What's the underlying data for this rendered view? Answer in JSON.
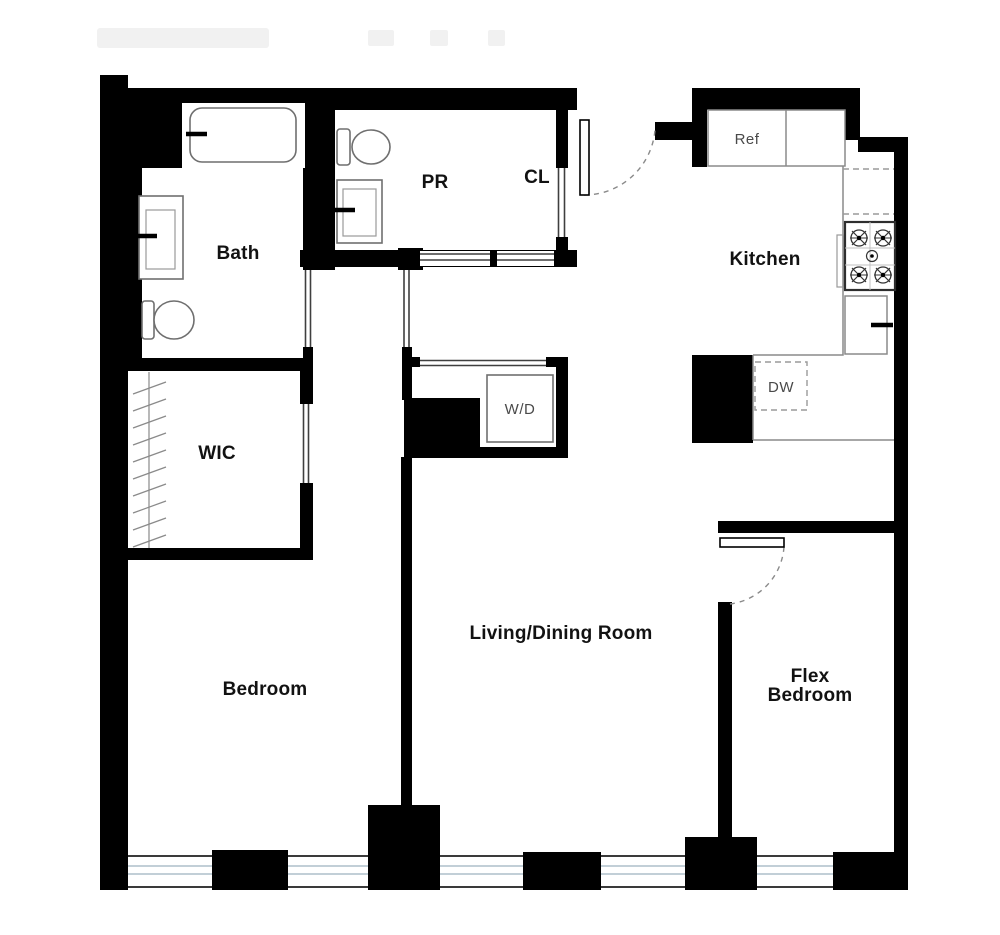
{
  "palette": {
    "wall": "#000000",
    "fixture_stroke": "#6f6f6f",
    "appliance_text": "#4a4a4a",
    "window_glass": "#aebfca",
    "label_text": "#121212",
    "watermark": "#f1f1f1"
  },
  "rooms": {
    "bath": {
      "label": "Bath"
    },
    "powder_room": {
      "label": "PR"
    },
    "closet": {
      "label": "CL"
    },
    "kitchen": {
      "label": "Kitchen"
    },
    "walk_in_closet": {
      "label": "WIC"
    },
    "bedroom": {
      "label": "Bedroom"
    },
    "living_dining": {
      "label": "Living/Dining Room"
    },
    "flex_bedroom": {
      "line1": "Flex",
      "line2": "Bedroom"
    }
  },
  "appliances": {
    "refrigerator": {
      "label": "Ref"
    },
    "dishwasher": {
      "label": "DW"
    },
    "washer_dryer": {
      "label": "W/D"
    }
  }
}
